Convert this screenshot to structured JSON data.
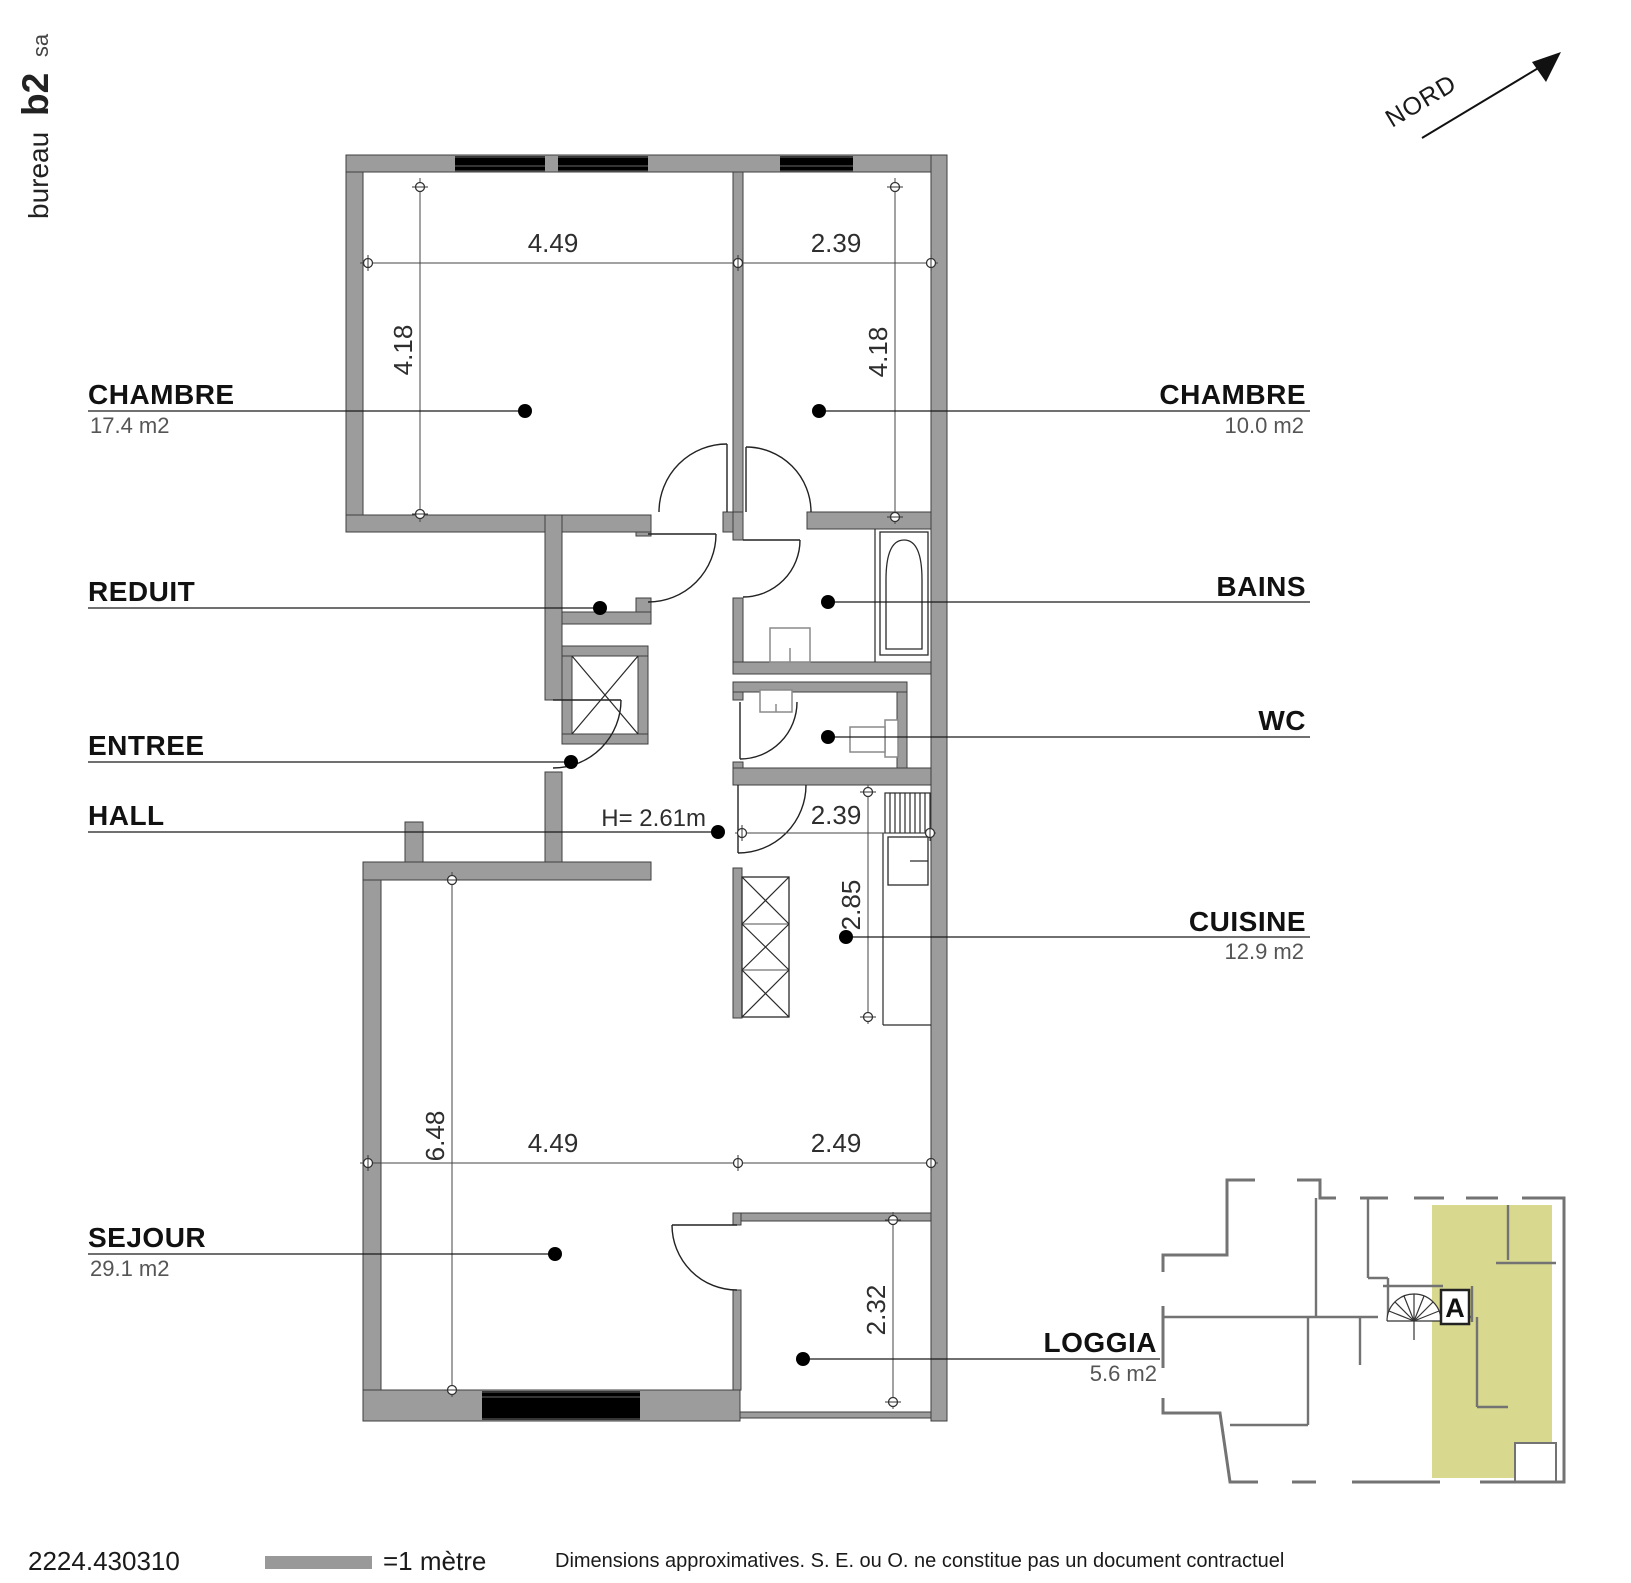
{
  "title_block": {
    "office_name": "bureau",
    "office_bold": "b2",
    "office_suffix": "sa"
  },
  "north": {
    "label": "NORD"
  },
  "plan": {
    "ceiling_height": "H= 2.61m",
    "rooms": {
      "chambre1": {
        "name": "CHAMBRE",
        "area": "17.4 m2"
      },
      "chambre2": {
        "name": "CHAMBRE",
        "area": "10.0 m2"
      },
      "reduit": {
        "name": "REDUIT"
      },
      "bains": {
        "name": "BAINS"
      },
      "entree": {
        "name": "ENTREE"
      },
      "wc": {
        "name": "WC"
      },
      "hall": {
        "name": "HALL"
      },
      "cuisine": {
        "name": "CUISINE",
        "area": "12.9 m2"
      },
      "sejour": {
        "name": "SEJOUR",
        "area": "29.1 m2"
      },
      "loggia": {
        "name": "LOGGIA",
        "area": "5.6 m2"
      }
    },
    "dimensions": {
      "chambre1_width": "4.49",
      "chambre2_width": "2.39",
      "chambre1_depth": "4.18",
      "chambre2_depth": "4.18",
      "cuisine_width": "2.39",
      "cuisine_depth": "2.85",
      "sejour_depth": "6.48",
      "sejour_width": "4.49",
      "loggia_width": "2.49",
      "loggia_depth": "2.32"
    }
  },
  "key_plan": {
    "unit_label": "A"
  },
  "footer": {
    "reference": "2224.430310",
    "scale_label": "=1 mètre",
    "disclaimer": "Dimensions approximatives. S. E. ou O. ne constitue pas un document contractuel"
  },
  "colors": {
    "wall": "#9c9c9c",
    "unit_highlight": "#d8d88f"
  }
}
